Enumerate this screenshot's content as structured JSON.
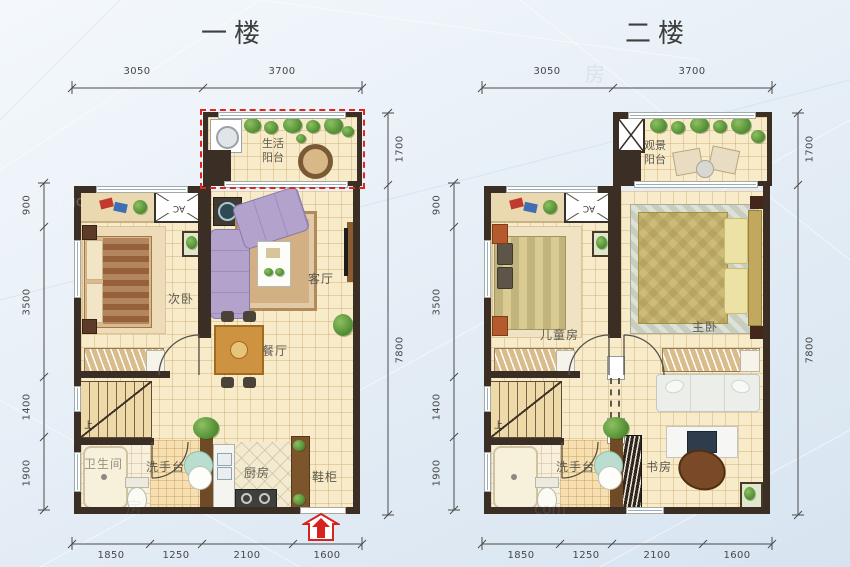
{
  "colors": {
    "wall": "#3b2f25",
    "floor_tile": "#f8ebc9",
    "accent_red": "#e02420",
    "window_glass": "#8fb2c2",
    "sofa_purple": "#b2a2cc"
  },
  "floor1": {
    "title": "一楼",
    "dims": {
      "top": [
        "3050",
        "3700"
      ],
      "right": [
        "1700",
        "7800"
      ],
      "left": [
        "900",
        "3500",
        "1400",
        "1900"
      ],
      "bottom": [
        "1850",
        "1250",
        "2100",
        "1600"
      ]
    },
    "rooms": {
      "balcony": "生活阳台",
      "bedroom": "次卧",
      "living": "客厅",
      "dining": "餐厅",
      "bath": "卫生间",
      "wash": "洗手台",
      "kitchen": "厨房",
      "shoe": "鞋柜"
    },
    "labels": {
      "ac": "AC",
      "up": "上"
    }
  },
  "floor2": {
    "title": "二楼",
    "dims": {
      "top": [
        "3050",
        "3700"
      ],
      "right": [
        "1700",
        "7800"
      ],
      "left": [
        "900",
        "3500",
        "1400",
        "1900"
      ],
      "bottom": [
        "1850",
        "1250",
        "2100",
        "1600"
      ]
    },
    "rooms": {
      "balcony": "观景阳台",
      "kids": "儿童房",
      "master": "主卧",
      "wash": "洗手台",
      "study": "书房"
    },
    "labels": {
      "ac": "AC",
      "up": "上"
    }
  },
  "watermarks": {
    "a": "ngc",
    "b": "房",
    "c": "com",
    "d": "房"
  }
}
